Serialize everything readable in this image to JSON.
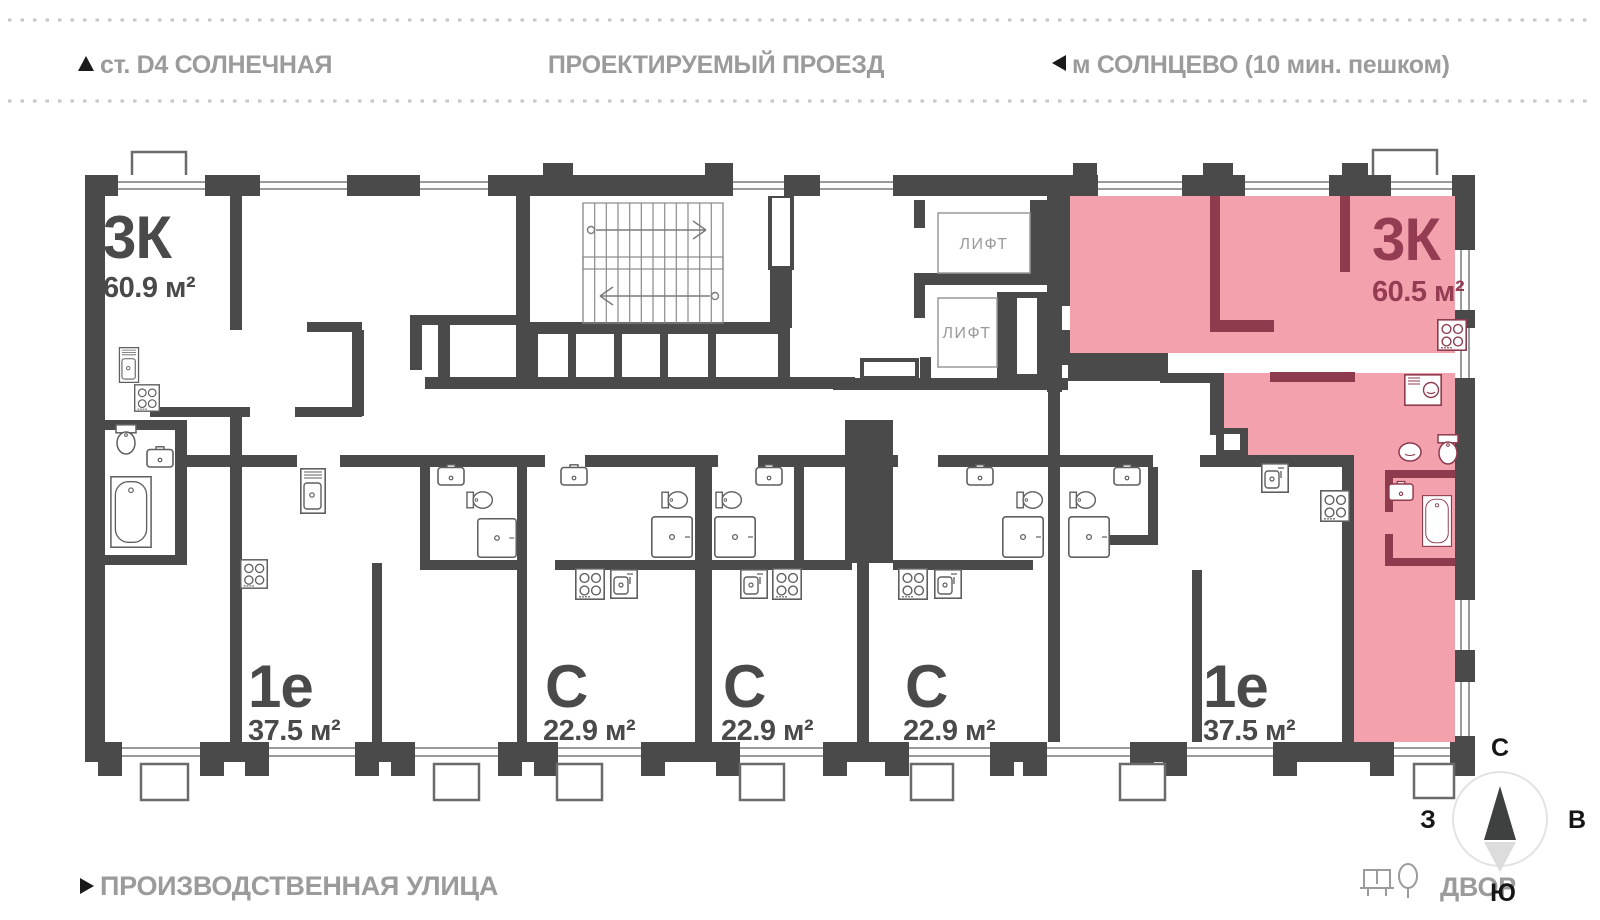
{
  "header": {
    "left_label": "ст. D4 СОЛНЕЧНАЯ",
    "center_label": "ПРОЕКТИРУЕМЫЙ ПРОЕЗД",
    "right_label": "м СОЛНЦЕВО (10 мин. пешком)"
  },
  "footer": {
    "street_label": "ПРОИЗВОДСТВЕННАЯ УЛИЦА",
    "courtyard_label": "ДВОР"
  },
  "compass": {
    "north": "С",
    "south": "Ю",
    "west": "З",
    "east": "В"
  },
  "elevator": {
    "label": "ЛИФТ"
  },
  "apartments": [
    {
      "id": "3k-left",
      "type": "3К",
      "area": "60.9 м²",
      "highlighted": false
    },
    {
      "id": "1e-left",
      "type": "1е",
      "area": "37.5 м²",
      "highlighted": false
    },
    {
      "id": "studio-1",
      "type": "С",
      "area": "22.9 м²",
      "highlighted": false
    },
    {
      "id": "studio-2",
      "type": "С",
      "area": "22.9 м²",
      "highlighted": false
    },
    {
      "id": "studio-3",
      "type": "С",
      "area": "22.9 м²",
      "highlighted": false
    },
    {
      "id": "1e-right",
      "type": "1е",
      "area": "37.5 м²",
      "highlighted": false
    },
    {
      "id": "3k-right",
      "type": "3К",
      "area": "60.5 м²",
      "highlighted": true
    }
  ],
  "colors": {
    "wall": "#4A4A4A",
    "highlight_fill": "#F4A1AE",
    "highlight_wall": "#8E3B4D",
    "highlight_text": "#943D52",
    "muted_text": "#9B9B9B",
    "fixture": "#5F5F5F",
    "glazing": "#9A9A9A"
  }
}
